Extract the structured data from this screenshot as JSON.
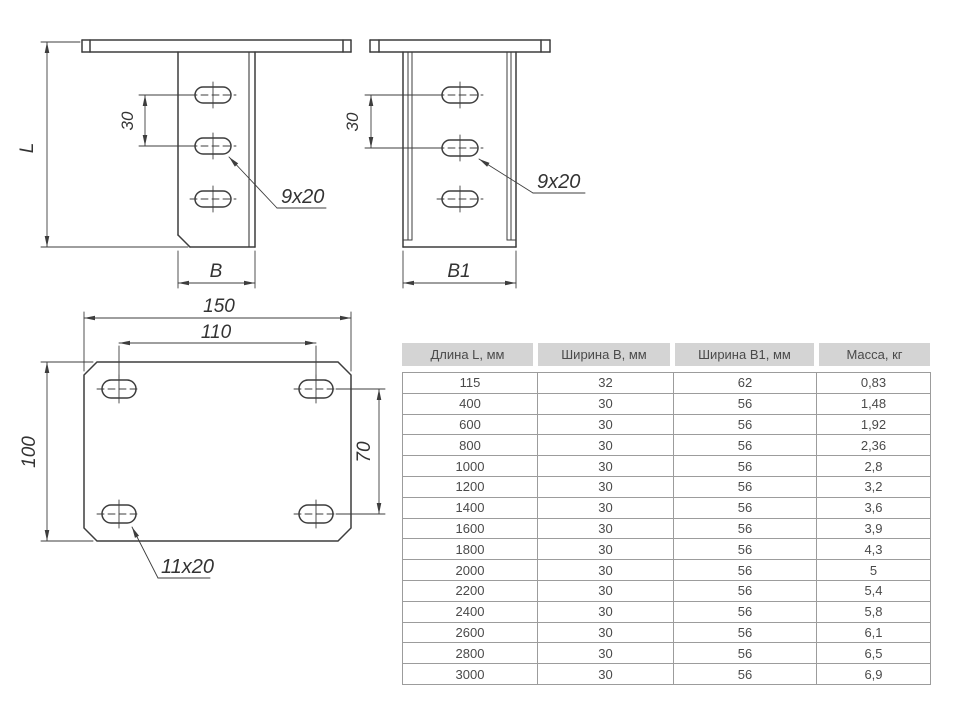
{
  "drawing": {
    "front": {
      "l_label": "L",
      "spacing_label": "30",
      "width_label": "B",
      "hole_callout": "9x20"
    },
    "side": {
      "spacing_label": "30",
      "width_label": "B1",
      "hole_callout": "9x20"
    },
    "plan": {
      "width_label": "150",
      "hole_span_x": "110",
      "height_label": "100",
      "hole_span_y": "70",
      "hole_callout": "11x20"
    }
  },
  "colors": {
    "line": "#3d3d3d",
    "table_header_bg": "#d4d4d4",
    "table_border": "#9c9c9c",
    "text": "#4a4a4a"
  },
  "table": {
    "headers": [
      "Длина L, мм",
      "Ширина B, мм",
      "Ширина B1, мм",
      "Масса, кг"
    ],
    "rows": [
      {
        "l": "115",
        "b": "32",
        "b1": "62",
        "m": "0,83"
      },
      {
        "l": "400",
        "b": "30",
        "b1": "56",
        "m": "1,48"
      },
      {
        "l": "600",
        "b": "30",
        "b1": "56",
        "m": "1,92"
      },
      {
        "l": "800",
        "b": "30",
        "b1": "56",
        "m": "2,36"
      },
      {
        "l": "1000",
        "b": "30",
        "b1": "56",
        "m": "2,8"
      },
      {
        "l": "1200",
        "b": "30",
        "b1": "56",
        "m": "3,2"
      },
      {
        "l": "1400",
        "b": "30",
        "b1": "56",
        "m": "3,6"
      },
      {
        "l": "1600",
        "b": "30",
        "b1": "56",
        "m": "3,9"
      },
      {
        "l": "1800",
        "b": "30",
        "b1": "56",
        "m": "4,3"
      },
      {
        "l": "2000",
        "b": "30",
        "b1": "56",
        "m": "5"
      },
      {
        "l": "2200",
        "b": "30",
        "b1": "56",
        "m": "5,4"
      },
      {
        "l": "2400",
        "b": "30",
        "b1": "56",
        "m": "5,8"
      },
      {
        "l": "2600",
        "b": "30",
        "b1": "56",
        "m": "6,1"
      },
      {
        "l": "2800",
        "b": "30",
        "b1": "56",
        "m": "6,5"
      },
      {
        "l": "3000",
        "b": "30",
        "b1": "56",
        "m": "6,9"
      }
    ]
  }
}
